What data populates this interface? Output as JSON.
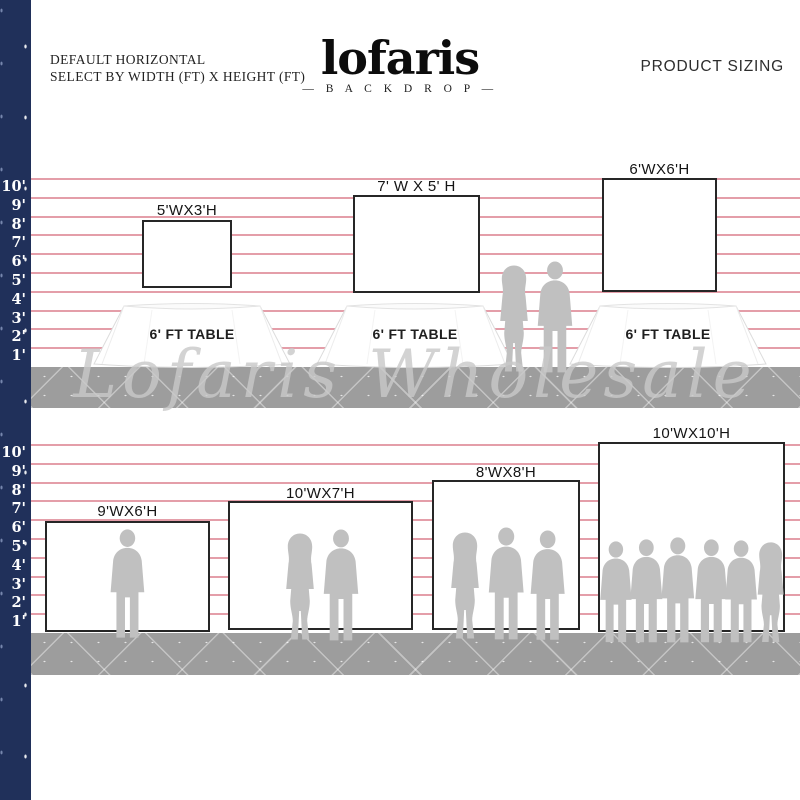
{
  "header": {
    "subtitle_line1": "DEFAULT HORIZONTAL",
    "subtitle_line2": "SELECT BY WIDTH (FT) X HEIGHT (FT)",
    "brand": "lofaris",
    "brand_sub": "— B A C K D R O P —",
    "title_right": "PRODUCT SIZING"
  },
  "watermark": "Lofaris Wholesale",
  "ruler": {
    "unit": "ft",
    "labels": [
      "10'",
      "9'",
      "8'",
      "7'",
      "6'",
      "5'",
      "4'",
      "3'",
      "2'",
      "1'"
    ]
  },
  "sections": [
    {
      "id": "tabletop-backdrops",
      "backdrops": [
        {
          "label": "5'WX3'H",
          "width_ft": 5,
          "height_ft": 3
        },
        {
          "label": "7' W X 5' H",
          "width_ft": 7,
          "height_ft": 5
        },
        {
          "label": "6'WX6'H",
          "width_ft": 6,
          "height_ft": 6
        }
      ],
      "tables": [
        {
          "label": "6' FT TABLE"
        },
        {
          "label": "6' FT TABLE"
        },
        {
          "label": "6' FT TABLE"
        }
      ],
      "people_groups": [
        {
          "type": "couple",
          "count": 2
        }
      ]
    },
    {
      "id": "floor-standing-backdrops",
      "backdrops": [
        {
          "label": "9'WX6'H",
          "width_ft": 9,
          "height_ft": 6,
          "people_count": 1
        },
        {
          "label": "10'WX7'H",
          "width_ft": 10,
          "height_ft": 7,
          "people_count": 2
        },
        {
          "label": "8'WX8'H",
          "width_ft": 8,
          "height_ft": 8,
          "people_count": 3
        },
        {
          "label": "10'WX10'H",
          "width_ft": 10,
          "height_ft": 10,
          "people_count": 6
        }
      ]
    }
  ],
  "colors": {
    "accent_navy": "#20305a",
    "guide_line_pink": "#e49ea9",
    "floor_gray": "#9d9d9d",
    "silhouette_gray": "#c0c0c0",
    "backdrop_border": "#262626"
  }
}
